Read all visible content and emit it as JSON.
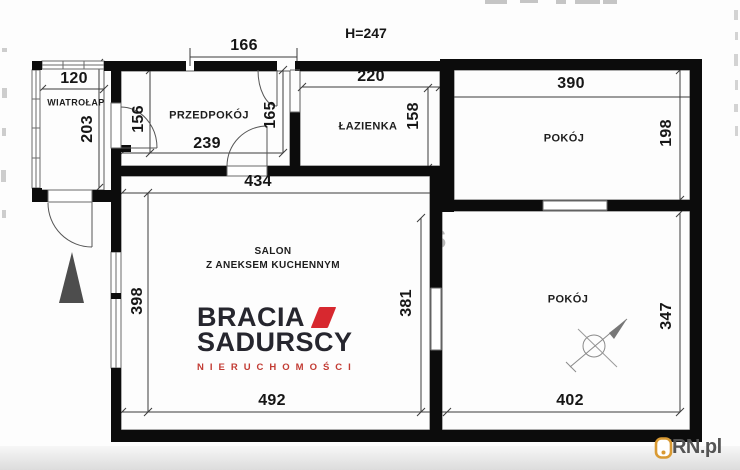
{
  "plan": {
    "height_label": "H=247",
    "rooms": {
      "wiatrolap": "WIATROŁAP",
      "przedpokoj": "PRZEDPOKÓJ",
      "lazienka": "ŁAZIENKA",
      "pokoj_top": "POKÓJ",
      "pokoj_bottom": "POKÓJ",
      "salon_line1": "SALON",
      "salon_line2": "Z ANEKSEM KUCHENNYM"
    },
    "dimensions": {
      "top_opening": "166",
      "wiatrolap_width": "120",
      "wiatrolap_depth": "203",
      "przedpokoj_left": "156",
      "przedpokoj_width": "239",
      "przedpokoj_right": "165",
      "lazienka_width": "220",
      "lazienka_depth": "158",
      "pokoj_top_width": "390",
      "pokoj_top_depth": "198",
      "hall_span": "434",
      "salon_depth": "398",
      "salon_width": "492",
      "pokoj_bottom_left": "381",
      "pokoj_bottom_width": "402",
      "pokoj_bottom_depth": "347"
    },
    "watermark_letter": "S"
  },
  "branding": {
    "agency_line1": "BRACIA",
    "agency_line2": "SADURSCY",
    "agency_line3": "NIERUCHOMOŚCI",
    "portal": "KRN.pl"
  },
  "icons": {
    "north_arrow": "north-arrow",
    "ceiling_fan": "ceiling-fan",
    "krn_badge": "padlock"
  },
  "colors": {
    "wall": "#0c0c0c",
    "accent_red": "#d7282f",
    "logo_dark": "#26262e",
    "krn_orange": "#d99a33"
  }
}
